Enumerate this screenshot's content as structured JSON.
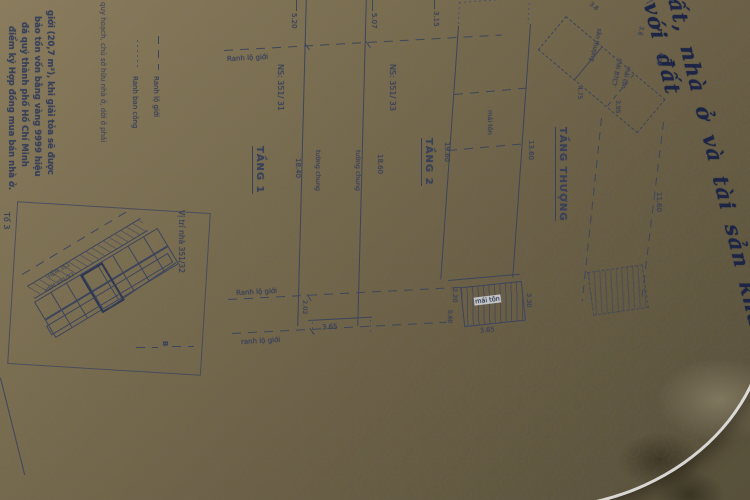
{
  "certificate_title": "ất, nhà ở và tài sản khác gắn liền với đất",
  "margin_notes": {
    "line1": "giới (20,7 m²), khi giải tỏa sẽ được",
    "line2": "bảo tồn vốn bằng vàng 9999 hiệu",
    "line3": "đá quý thành phố Hồ Chí Minh",
    "line4": "điểm ký Hợp đồng mua bán nhà ở.",
    "small_line": "quy hoạch, chủ sở hữu nhà ở, dời ở phải",
    "group_label": "Tổ 3"
  },
  "legend": {
    "lo_gioi": "Ranh lộ giới",
    "ban_cong": "Ranh ban công"
  },
  "boundary": {
    "label_top": "Ranh lộ giới",
    "label_mid": "Ranh lộ giới",
    "label_bottom": "ranh lộ giới"
  },
  "floor1": {
    "title": "TẦNG 1",
    "neighbor_left": "NS: 351/ 31",
    "neighbor_right": "NS: 351/ 33",
    "dim_top_left": "5.20",
    "dim_top_right": "5.07",
    "dim_left": "18.40",
    "dim_right": "18.60",
    "wall_left": "tường chung",
    "wall_right": "tường chung",
    "dim_front_width": "3.65",
    "dim_front_setback": "2.02"
  },
  "floor2": {
    "title": "TẦNG 2",
    "dim_top": "3.15",
    "dim_left": "19.60",
    "dim_right": "13.60",
    "roof_label": "mái tôn",
    "dim_setback": "2.20",
    "porch_roof_label": "mái tôn",
    "dim_porch_width": "3.65",
    "dim_porch_depth": "3.30",
    "dim_porch_side": "0.60"
  },
  "roof_floor": {
    "title": "TẦNG THƯỢNG",
    "room1": "sân thượng",
    "room2a": "mái BTCT",
    "room2b": "mái tôn",
    "dim_a": "3.8",
    "dim_b": "3.6",
    "dim_c": "4.05",
    "dim_d": "4.75",
    "dim_e": "3.95",
    "dim_side": "11.60"
  },
  "site_map": {
    "title": "Vị trí nhà 351/32",
    "road_label_1": "HẺM 351",
    "road_label_2": "HẺM 351/32",
    "marker": "B"
  }
}
